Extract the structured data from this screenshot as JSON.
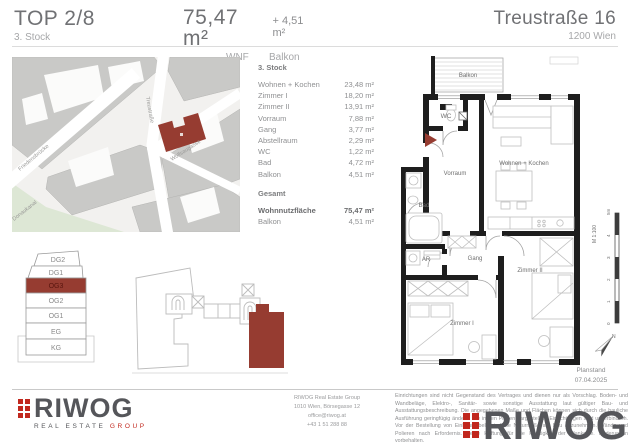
{
  "header": {
    "top_label": "TOP 2/8",
    "floor_label": "3. Stock",
    "area_main": "75,47 m²",
    "area_plus": "+ 4,51 m²",
    "area_main_caption": "WNF",
    "area_plus_caption": "Balkon",
    "address": "Treustraße 16",
    "city": "1200 Wien"
  },
  "map": {
    "streets": [
      "Treustraße",
      "Wolfsaugasse",
      "Friedensbrücke",
      "Donaukanal"
    ]
  },
  "room_table": {
    "floor_heading": "3. Stock",
    "rows": [
      {
        "label": "Wohnen + Kochen",
        "value": "23,48 m²"
      },
      {
        "label": "Zimmer I",
        "value": "18,20 m²"
      },
      {
        "label": "Zimmer II",
        "value": "13,91 m²"
      },
      {
        "label": "Vorraum",
        "value": "7,88 m²"
      },
      {
        "label": "Gang",
        "value": "3,77 m²"
      },
      {
        "label": "Abstellraum",
        "value": "2,29 m²"
      },
      {
        "label": "WC",
        "value": "1,22 m²"
      },
      {
        "label": "Bad",
        "value": "4,72 m²"
      },
      {
        "label": "Balkon",
        "value": "4,51 m²"
      }
    ],
    "total_heading": "Gesamt",
    "total_rows": [
      {
        "label": "Wohnnutzfläche",
        "value": "75,47 m²"
      },
      {
        "label": "Balkon",
        "value": "4,51 m²"
      }
    ]
  },
  "floor_plan": {
    "rooms": {
      "balkon": "Balkon",
      "wc": "WC",
      "wohnen": "Wohnen + Kochen",
      "vorraum": "Vorraum",
      "bad": "Bad",
      "ar": "AR",
      "gang": "Gang",
      "zimmer2": "Zimmer II",
      "zimmer1": "Zimmer I"
    }
  },
  "levels": {
    "items": [
      {
        "label": "DG2",
        "active": false
      },
      {
        "label": "DG1",
        "active": false
      },
      {
        "label": "OG3",
        "active": true
      },
      {
        "label": "OG2",
        "active": false
      },
      {
        "label": "OG1",
        "active": false
      },
      {
        "label": "EG",
        "active": false
      },
      {
        "label": "KG",
        "active": false
      }
    ]
  },
  "scale": {
    "label": "M 1:100",
    "ticks": [
      "5m",
      "4",
      "3",
      "2",
      "1",
      "0"
    ],
    "north": "N"
  },
  "plan_status": {
    "label": "Planstand",
    "date": "07.04.2025"
  },
  "footer": {
    "logo_text": "RIWOG",
    "logo_sub_1": "REAL ESTATE",
    "logo_sub_2": "GROUP",
    "contact_lines": [
      "RIWOG Real Estate Group",
      "1010 Wien, Börsegasse 12",
      "office@riwog.at",
      "+43 1 51 288 88"
    ],
    "legal_text": "Einrichtungen sind nicht Gegenstand des Vertrages und dienen nur als Vorschlag. Boden- und Wandbeläge, Elektro-, Sanitär- sowie sonstige Ausstattung laut gültiger Bau- und Ausstattungsbeschreibung. Die angegebenen Maße und Flächen können sich durch die bauliche Ausführung geringfügig ändern. Die in den Plänen dargestellten Einrichtungen sind unverbindlich. Vor der Bestellung von Einbaumöbeln sind die Naturmaße am Bau abzunehmen. Wände und Polieren nach Erfordernis. Keine Haftung für die Richtigkeit der Plankopie. Änderungen vorbehalten."
  },
  "colors": {
    "accent_red": "#963c31",
    "logo_red": "#c1281e",
    "wall_black": "#1e1e1e",
    "text_dark": "#707174",
    "text_gray": "#9b9c9e"
  }
}
